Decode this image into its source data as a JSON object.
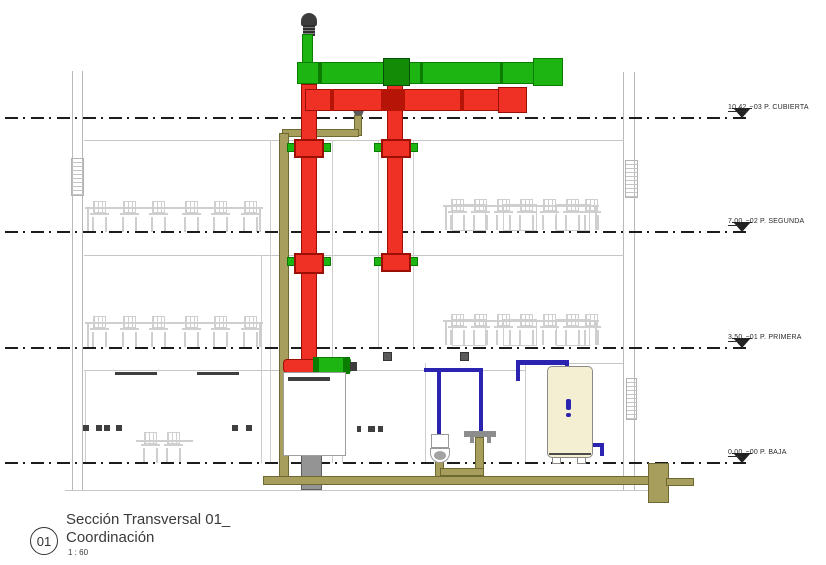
{
  "view": {
    "number": "01",
    "title_line1": "Sección Transversal 01_",
    "title_line2": "Coordinación",
    "scale": "1 : 60"
  },
  "levels": [
    {
      "value": "10.42",
      "label": "−03 P. CUBIERTA"
    },
    {
      "value": "7.00",
      "label": "−02 P. SEGUNDA"
    },
    {
      "value": "3.50",
      "label": "−01 P. PRIMERA"
    },
    {
      "value": "0.00",
      "label": "−00 P. BAJA"
    }
  ],
  "colors": {
    "supply_duct_green": "#1db512",
    "supply_duct_green_dark": "#0a7c00",
    "exhaust_duct_red": "#ee3124",
    "exhaust_duct_red_dark": "#9c0f05",
    "waste_pipe_olive": "#a79e5e",
    "waste_pipe_olive_dark": "#6e6831",
    "water_pipe_blue": "#2a24b0",
    "heater_fill": "#f4efd2",
    "structure_gray": "#b9b9b9",
    "furniture_gray": "#cfcfcf",
    "annotation_ink": "#1c1c1c"
  }
}
